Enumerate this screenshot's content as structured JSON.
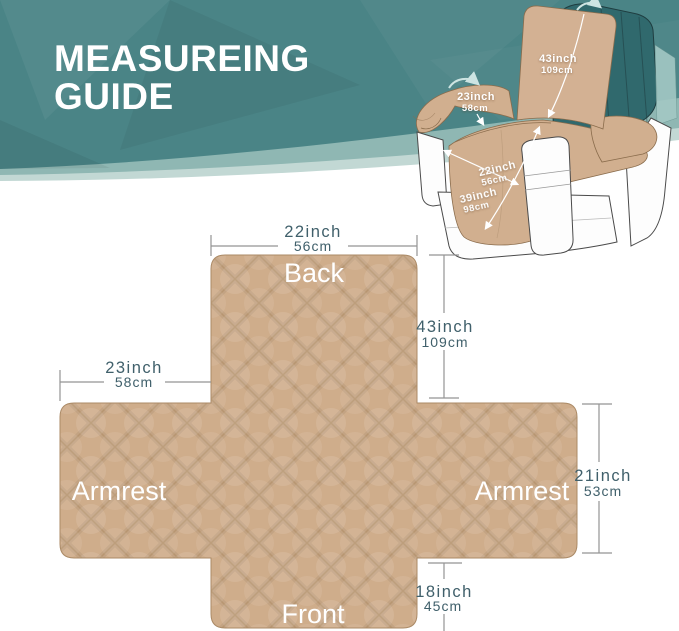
{
  "banner": {
    "title_line1": "MEASUREING",
    "title_line2": "GUIDE"
  },
  "chair_diagram": {
    "back_length": {
      "inch": "43inch",
      "cm": "109cm"
    },
    "armrest_width": {
      "inch": "23inch",
      "cm": "58cm"
    },
    "seat_width": {
      "inch": "22inch",
      "cm": "56cm"
    },
    "seat_length": {
      "inch": "39inch",
      "cm": "98cm"
    }
  },
  "flat_diagram": {
    "labels": {
      "back": "Back",
      "armrest_left": "Armrest",
      "armrest_right": "Armrest",
      "front": "Front"
    },
    "back_width": {
      "inch": "22inch",
      "cm": "56cm"
    },
    "back_length": {
      "inch": "43inch",
      "cm": "109cm"
    },
    "armrest_width": {
      "inch": "23inch",
      "cm": "58cm"
    },
    "armrest_length": {
      "inch": "21inch",
      "cm": "53cm"
    },
    "front_length": {
      "inch": "18inch",
      "cm": "45cm"
    }
  },
  "colors": {
    "teal": "#4a8486",
    "teal_light": "#8fb7b3",
    "teal_lighter": "#c2d8d4",
    "tan": "#cfad8b",
    "dim_text": "#40606b",
    "dim_line": "#949494"
  }
}
